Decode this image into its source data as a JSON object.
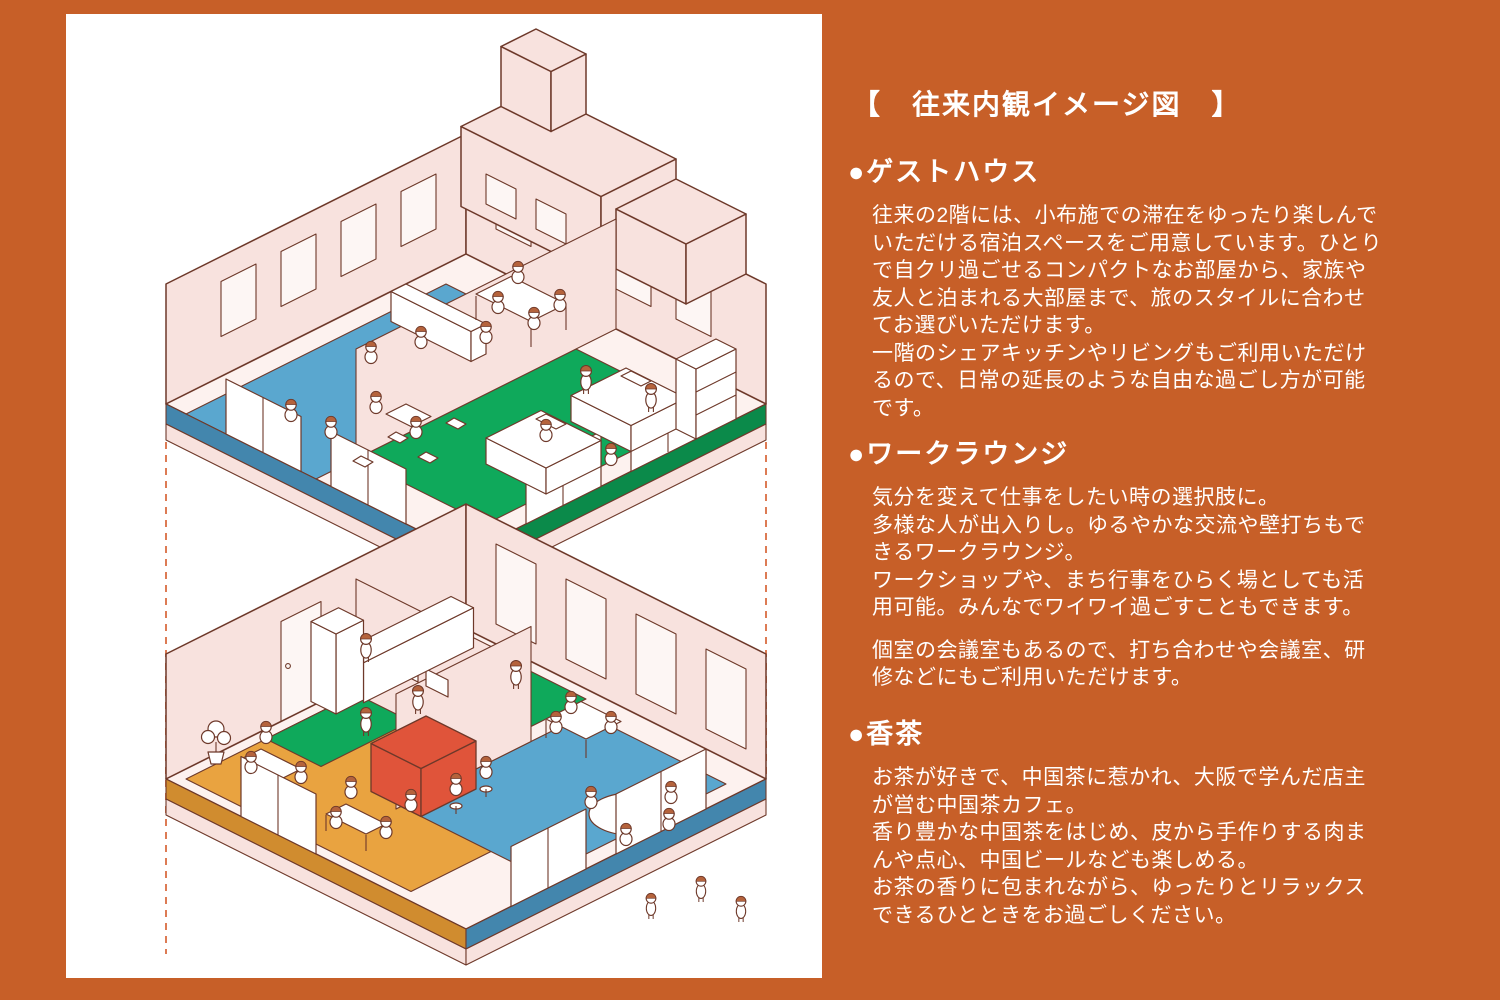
{
  "colors": {
    "background": "#c75f28",
    "panel": "#ffffff",
    "text": "#ffffff",
    "outline": "#6e392a",
    "wall_pink": "#f8e2de",
    "floor_pink": "#fdf2ef",
    "floor2_lounge_blue": "#5aa7cf",
    "floor2_bedroom_green": "#0fa95b",
    "floor1_kitchen_green": "#0fa95b",
    "floor1_worklounge_blue": "#5aa7cf",
    "floor1_cafe_orange": "#e9a340",
    "cafe_counter_red": "#e0543a",
    "hair_brown": "#b5633c",
    "guide_dash": "#dd7b54"
  },
  "title": "【　往来内観イメージ図　】",
  "sections": [
    {
      "heading": "●ゲストハウス",
      "paragraphs": [
        "往来の2階には、小布施での滞在をゆったり楽しんで\nいただける宿泊スペースをご用意しています。ひとり\nで自クリ過ごせるコンパクトなお部屋から、家族や\n友人と泊まれる大部屋まで、旅のスタイルに合わせ\nてお選びいただけます。\n一階のシェアキッチンやリビングもご利用いただけ\nるので、日常の延長のような自由な過ごし方が可能\nです。"
      ]
    },
    {
      "heading": "●ワークラウンジ",
      "paragraphs": [
        "気分を変えて仕事をしたい時の選択肢に。\n多様な人が出入りし。ゆるやかな交流や壁打ちもで\nきるワークラウンジ。\nワークショップや、まち行事をひらく場としても活\n用可能。みんなでワイワイ過ごすこともできます。",
        "個室の会議室もあるので、打ち合わせや会議室、研\n修などにもご利用いただけます。"
      ]
    },
    {
      "heading": "●香茶",
      "paragraphs": [
        "お茶が好きで、中国茶に惹かれ、大阪で学んだ店主\nが営む中国茶カフェ。\n香り豊かな中国茶をはじめ、皮から手作りする肉ま\nんや点心、中国ビールなども楽しめる。\nお茶の香りに包まれながら、ゆったりとリラックス\nできるひとときをお過ごしください。"
      ]
    }
  ]
}
